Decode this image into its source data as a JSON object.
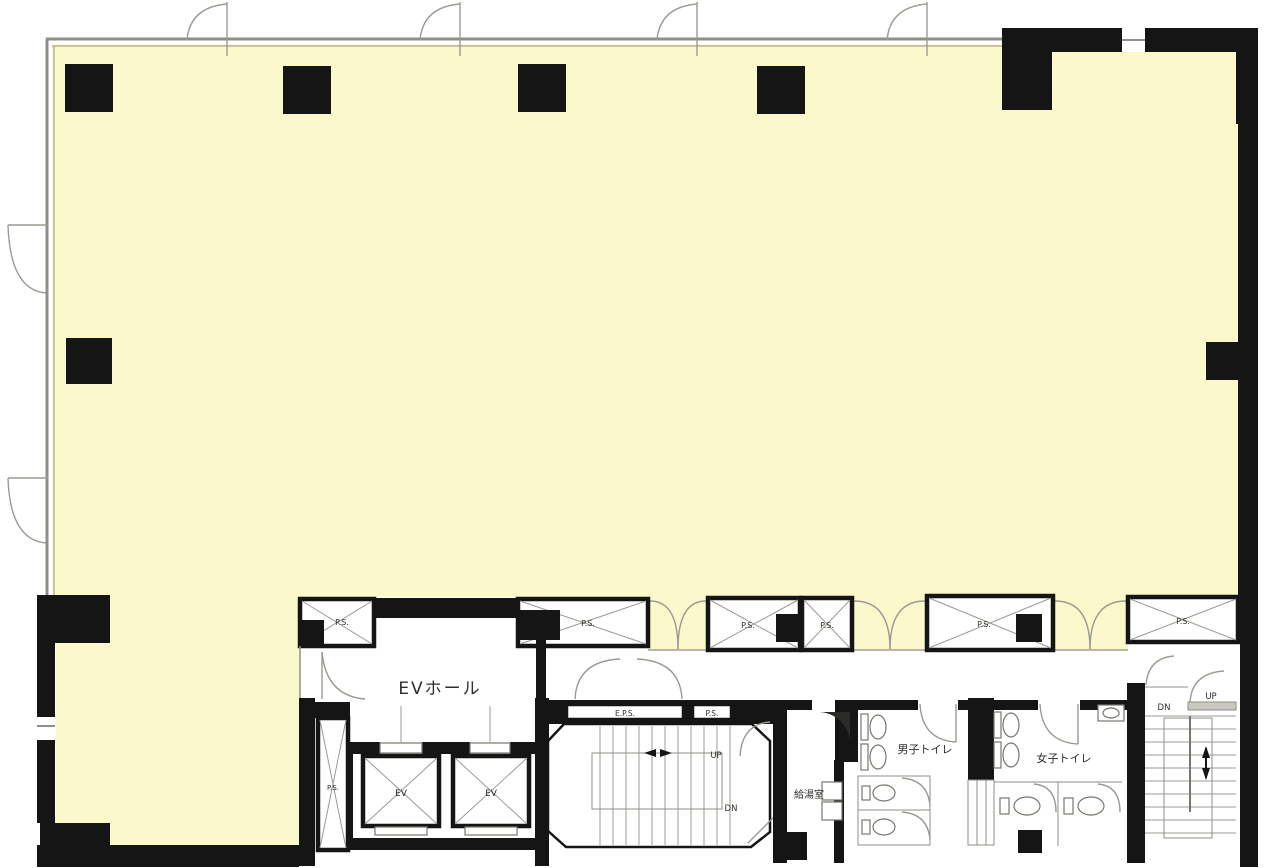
{
  "plan": {
    "title": "office-floor-plan",
    "rooms": {
      "ev_hall": "EVホール",
      "kitchen": "給湯室",
      "mens_toilet": "男子トイレ",
      "womens_toilet": "女子トイレ"
    },
    "labels": {
      "elevator": "EV",
      "pipe_space": "P.S.",
      "electrical_pipe_space": "E.P.S.",
      "up": "UP",
      "down": "DN"
    },
    "colors": {
      "office_fill": "#FBF9CB",
      "wall": "#151515",
      "thin_line": "#8F8F87"
    }
  }
}
